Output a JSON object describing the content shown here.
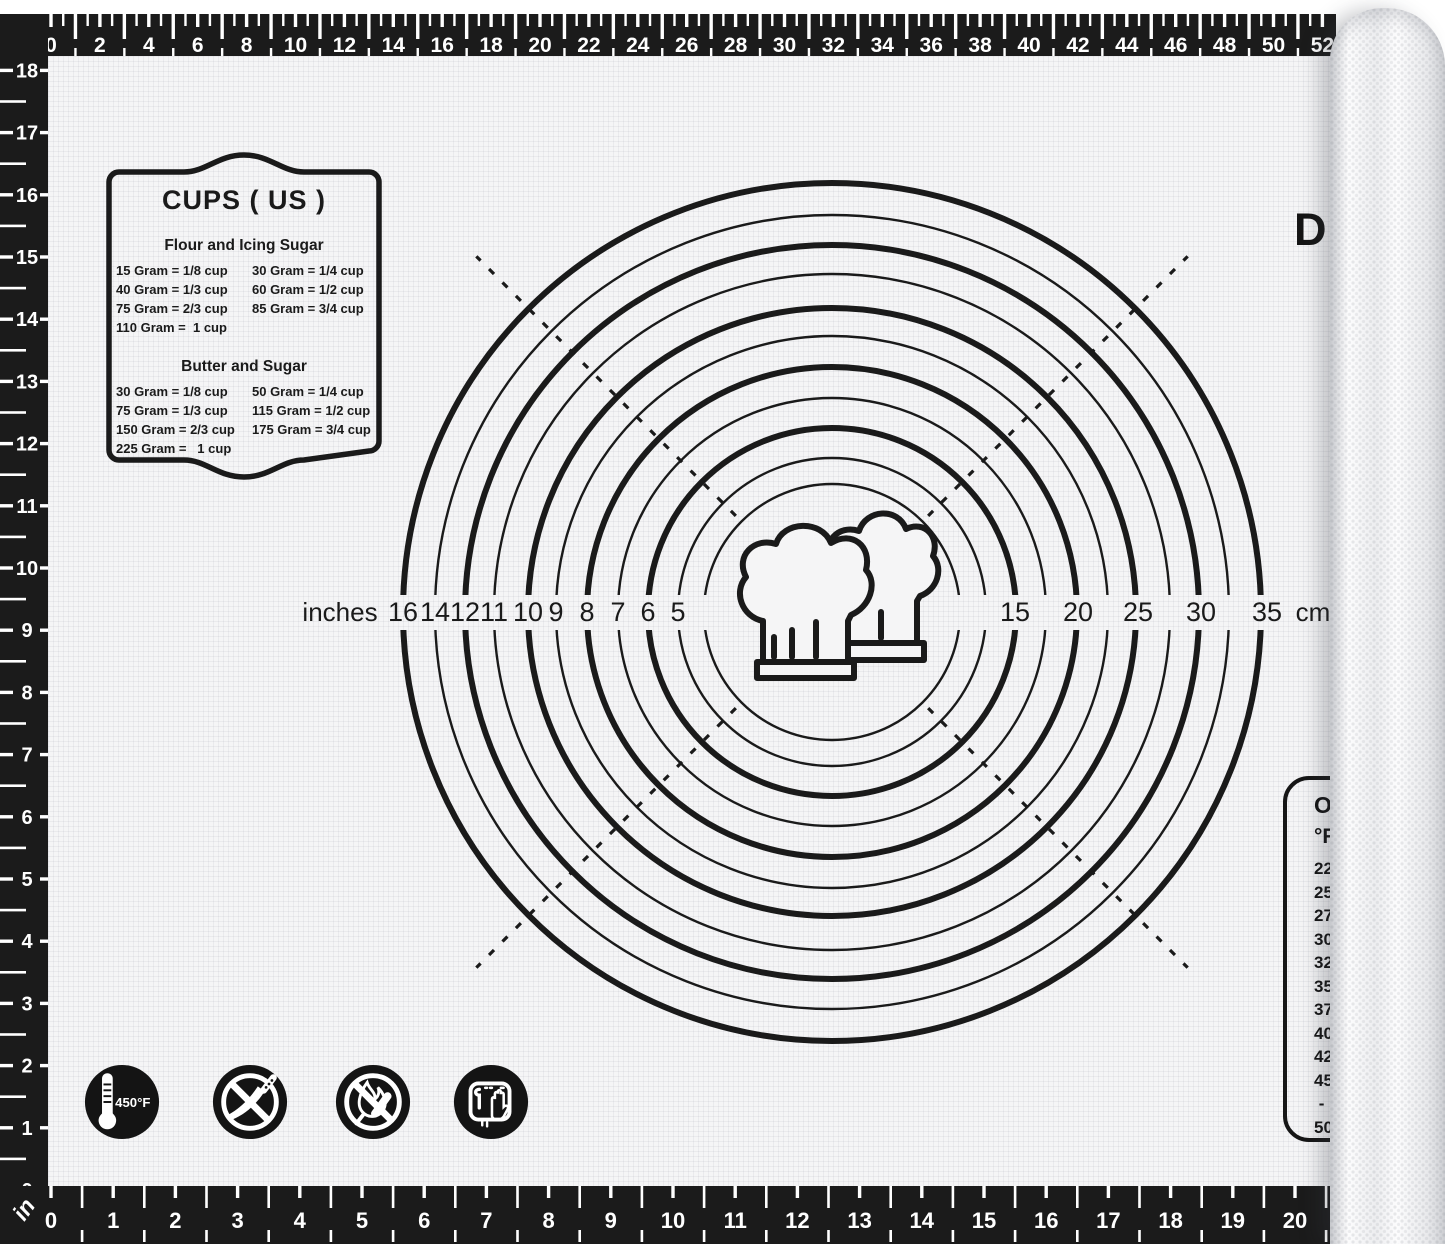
{
  "brand": {
    "visible_text": "D"
  },
  "rulers": {
    "top": {
      "unit": "cm",
      "min": 0,
      "max": 52,
      "label_step": 2
    },
    "bottom": {
      "unit": "in",
      "min": 0,
      "max": 21,
      "label_max": 20,
      "label_step": 1
    },
    "left": {
      "unit_label": "in",
      "min": 0,
      "max": 18,
      "label_step": 1
    }
  },
  "cups_box": {
    "title": "CUPS ( US )",
    "sections": [
      {
        "heading": "Flour and Icing Sugar",
        "left": [
          "15 Gram = 1/8 cup",
          "40 Gram = 1/3 cup",
          "75 Gram = 2/3 cup",
          "110 Gram =  1 cup"
        ],
        "right": [
          "30 Gram = 1/4 cup",
          "60 Gram = 1/2 cup",
          "85 Gram = 3/4 cup",
          ""
        ]
      },
      {
        "heading": "Butter and Sugar",
        "left": [
          "30 Gram = 1/8 cup",
          "75 Gram = 1/3 cup",
          "150 Gram = 2/3 cup",
          "225 Gram =   1 cup"
        ],
        "right": [
          "50 Gram = 1/4 cup",
          "115 Gram = 1/2 cup",
          "175 Gram = 3/4 cup",
          ""
        ]
      }
    ]
  },
  "circle_gauge": {
    "unit_left": "inches",
    "unit_right": "cm",
    "circles": [
      {
        "r": 429,
        "weight": "thick"
      },
      {
        "r": 397,
        "weight": "thin"
      },
      {
        "r": 367,
        "weight": "thick"
      },
      {
        "r": 338,
        "weight": "thin"
      },
      {
        "r": 304,
        "weight": "thick"
      },
      {
        "r": 276,
        "weight": "thin"
      },
      {
        "r": 245,
        "weight": "thick"
      },
      {
        "r": 214,
        "weight": "thin"
      },
      {
        "r": 184,
        "weight": "thick"
      },
      {
        "r": 154,
        "weight": "thin"
      },
      {
        "r": 128,
        "weight": "thin"
      }
    ],
    "inch_labels": [
      {
        "value": "16",
        "x": 403
      },
      {
        "value": "14",
        "x": 435
      },
      {
        "value": "12",
        "x": 465
      },
      {
        "value": "11",
        "x": 494
      },
      {
        "value": "10",
        "x": 528
      },
      {
        "value": "9",
        "x": 556
      },
      {
        "value": "8",
        "x": 587
      },
      {
        "value": "7",
        "x": 618
      },
      {
        "value": "6",
        "x": 648
      },
      {
        "value": "5",
        "x": 678
      }
    ],
    "cm_labels": [
      {
        "value": "15",
        "x": 1015
      },
      {
        "value": "20",
        "x": 1078
      },
      {
        "value": "25",
        "x": 1138
      },
      {
        "value": "30",
        "x": 1201
      },
      {
        "value": "35",
        "x": 1267
      }
    ]
  },
  "oven_box": {
    "title": "Ov",
    "unit": "°F",
    "values": [
      "225",
      "250",
      "275",
      "300",
      "325",
      "350",
      "375",
      "400",
      "425",
      "450",
      " -",
      "500"
    ]
  },
  "safety_badges": {
    "max_temp": "450°F"
  }
}
